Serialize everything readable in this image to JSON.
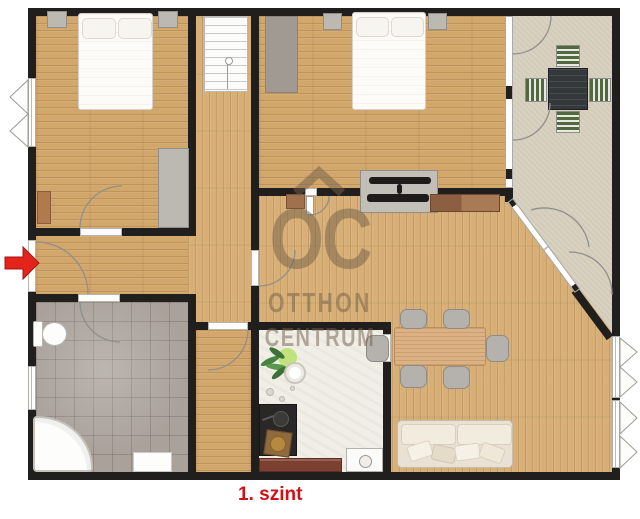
{
  "floor_label": "1. szint",
  "watermark": {
    "logo_text": "OC",
    "line1": "OTTHON",
    "line2": "CENTRUM"
  },
  "entrance_marker": "red-arrow",
  "colors": {
    "wall": "#211f1e",
    "wood_h": "#d2a76c",
    "wood_v": "#d8b077",
    "tile": "#a9a19a",
    "terrace": "#d9d2c0",
    "kitchen_floor": "#f1eee6",
    "window": "#fdfdfb",
    "accent_red": "#e2241b",
    "label_red": "#d21016",
    "watermark": "rgba(112,94,72,0.5)",
    "furniture_gray": "#bcb8b2",
    "bed_white": "#fcfbf8",
    "chair_gray": "#b5b2ae",
    "sofa_beige": "#e9e2d4",
    "table_wood": "#dcb183",
    "counter_brown": "#7c4030",
    "stove_dark": "#2a2826",
    "dresser_brown": "#b07a4e",
    "terrace_table_dark": "#34383a",
    "terrace_chair_green": "#52693f"
  }
}
